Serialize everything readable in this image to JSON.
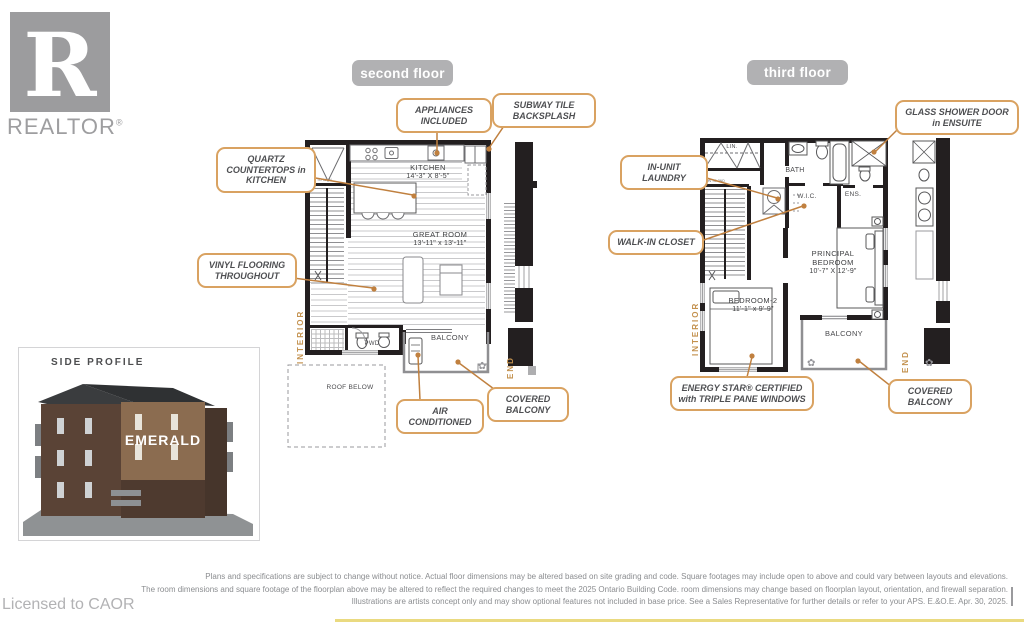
{
  "branding": {
    "logo_letter": "R",
    "logo_word": "REALTOR",
    "reg": "®",
    "licensed_to": "Licensed to CAOR"
  },
  "floors": {
    "second": {
      "title": "second floor",
      "rooms": {
        "kitchen": {
          "name": "KITCHEN",
          "dims": "14'-3\" X 8'-5\""
        },
        "great_room": {
          "name": "GREAT ROOM",
          "dims": "13'-11\" x 13'-11\""
        },
        "balcony": "BALCONY",
        "pwd": "PWD",
        "roof_below": "ROOF BELOW",
        "stair_note": "DN TO MAIN"
      },
      "side": {
        "interior": "INTERIOR",
        "end": "END"
      },
      "callouts": {
        "appliances": "APPLIANCES INCLUDED",
        "subway": "SUBWAY TILE BACKSPLASH",
        "quartz": "QUARTZ COUNTERTOPS in KITCHEN",
        "vinyl": "VINYL FLOORING THROUGHOUT",
        "air": "AIR CONDITIONED",
        "covered_balcony": "COVERED BALCONY"
      }
    },
    "third": {
      "title": "third floor",
      "rooms": {
        "principal": {
          "name": "PRINCIPAL BEDROOM",
          "dims": "10'-7\" X 12'-9\""
        },
        "bedroom2": {
          "name": "BEDROOM-2",
          "dims": "11'-1\" x 9'-9\""
        },
        "balcony": "BALCONY",
        "bath": "BATH",
        "wic": "W.I.C.",
        "ens": "ENS.",
        "lin": "LIN.",
        "stair_note": "DN TO 2ND"
      },
      "side": {
        "interior": "INTERIOR",
        "end": "END"
      },
      "callouts": {
        "glass_shower": "GLASS SHOWER DOOR in ENSUITE",
        "laundry": "IN-UNIT LAUNDRY",
        "walk_in": "WALK-IN CLOSET",
        "energy_star": "ENERGY STAR® CERTIFIED with TRIPLE PANE WINDOWS",
        "covered_balcony": "COVERED BALCONY"
      }
    }
  },
  "side_profile": {
    "title": "SIDE PROFILE",
    "building_name": "EMERALD"
  },
  "disclaimer": {
    "line1": "Plans and specifications are subject to change without notice. Actual floor dimensions may be altered based on site grading and code. Square footages may include open to above and could vary between layouts and elevations.",
    "line2": "The room dimensions and square footage of the floorplan above may be altered to reflect the required changes to meet the 2025 Ontario Building Code. room dimensions may change based on floorplan layout, orientation, and firewall separation.",
    "line3": "Illustrations are artists concept only and may show optional features not included in base price. See a Sales Representative for further details or refer to your APS. E.&O.E. Apr. 30, 2025."
  },
  "colors": {
    "callout_border": "#d9a261",
    "leader": "#c0803f",
    "accent_text": "#c3914e",
    "pill_bg": "#b1b1b3",
    "wall": "#231f20",
    "logo_gray": "#9c9c9e"
  }
}
